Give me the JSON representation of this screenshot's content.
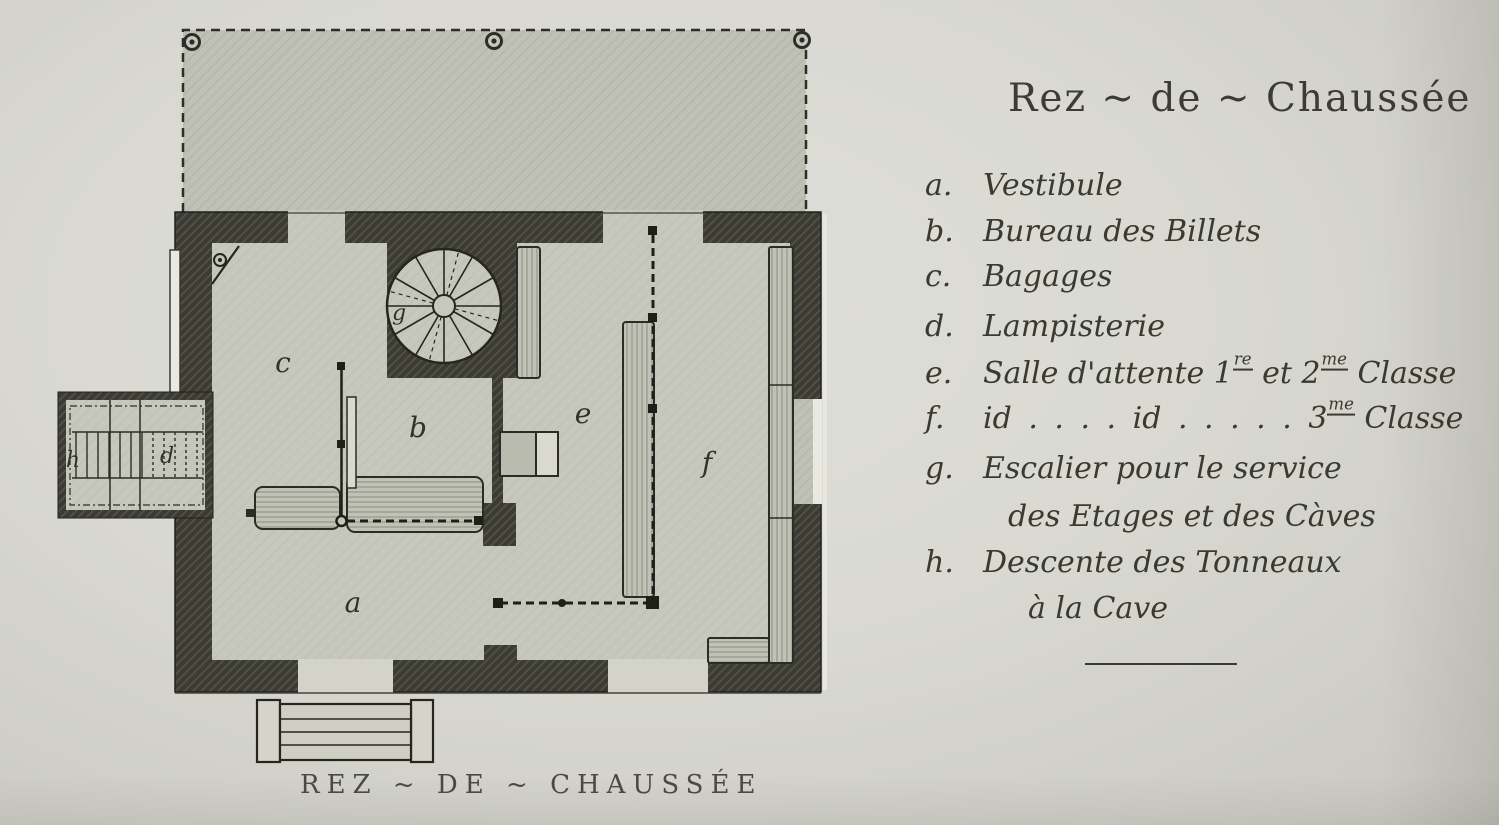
{
  "legend": {
    "title": "Rez ~ de ~ Chaussée",
    "items": [
      {
        "letter": "a.",
        "text": "Vestibule"
      },
      {
        "letter": "b.",
        "text": "Bureau des Billets"
      },
      {
        "letter": "c.",
        "text": "Bagages"
      },
      {
        "letter": "d.",
        "text": "Lampisterie"
      },
      {
        "letter": "e.",
        "pre": "Salle d'attente 1",
        "sup1": "re",
        "mid": " et 2",
        "sup2": "me",
        "post": " Classe"
      },
      {
        "letter": "f.",
        "pre": "id . . . . id . . . . . 3",
        "sup1": "me",
        "post": " Classe"
      },
      {
        "letter": "g.",
        "text": "Escalier pour le service",
        "line2": "des Etages et des Càves"
      },
      {
        "letter": "h.",
        "text": "Descente des Tonneaux",
        "line2": "à la Cave"
      }
    ]
  },
  "plan": {
    "caption": "REZ ~ DE ~ CHAUSSÉE",
    "room_letters": {
      "a": "a",
      "b": "b",
      "c": "c",
      "d": "d",
      "e": "e",
      "f": "f",
      "g": "g",
      "h": "h"
    }
  },
  "colors": {
    "paper": "#d8d8d1",
    "floor": "#c7c8bd",
    "canopy": "#bfc1b6",
    "wall": "#3b3b34",
    "ink": "#3a3a33"
  }
}
